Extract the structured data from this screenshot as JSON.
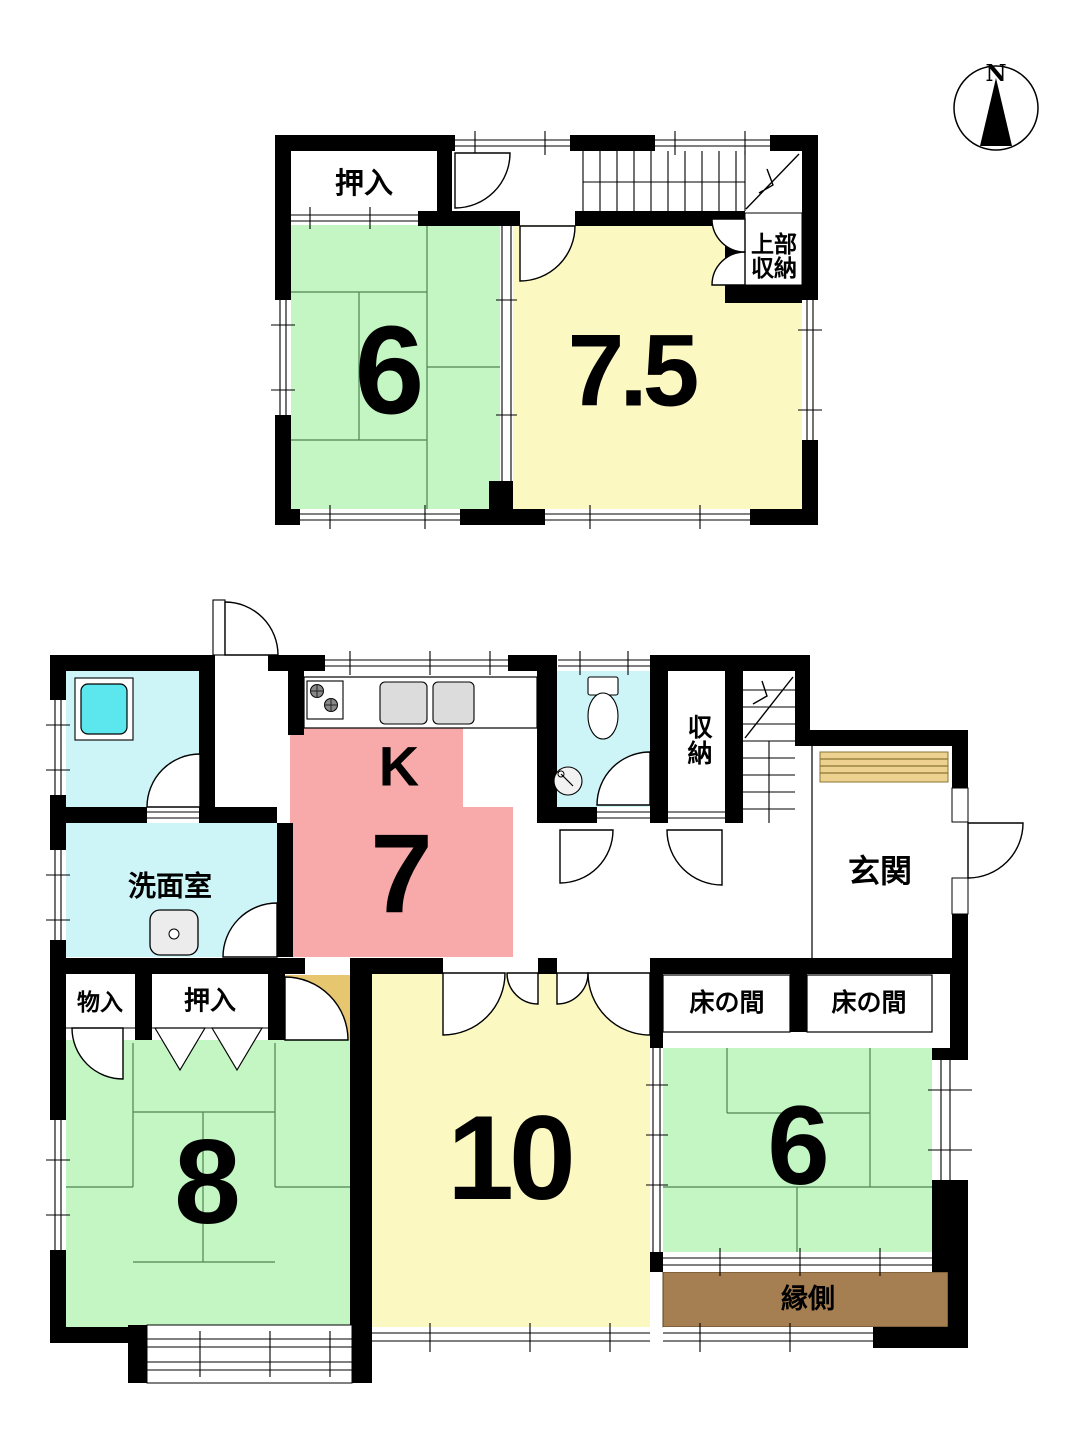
{
  "compass": {
    "north_label": "N"
  },
  "floor2": {
    "closet_label": "押入",
    "upper_storage_label": "上部収納",
    "room_tatami_west_size": "6",
    "room_east_size": "7.5"
  },
  "floor1": {
    "washroom_label": "洗面室",
    "kitchen_letter": "K",
    "kitchen_size": "7",
    "storage_label": "収納",
    "entrance_label": "玄関",
    "small_storage_label": "物入",
    "closet_label": "押入",
    "tokonoma_left_label": "床の間",
    "tokonoma_right_label": "床の間",
    "veranda_label": "縁側",
    "room_west_size": "8",
    "room_center_size": "10",
    "room_east_size": "6"
  },
  "colors": {
    "tatami_green": "#c3f6c3",
    "room_yellow": "#fbf8c2",
    "kitchen_pink": "#f8a9a9",
    "wet_area_cyan": "#cdf4f7",
    "bathtub_cyan": "#5ce6ee",
    "entry_step_tan": "#ecd28e",
    "corner_tan": "#e6c76f",
    "veranda_brown": "#a57e52",
    "wall_black": "#000000"
  }
}
